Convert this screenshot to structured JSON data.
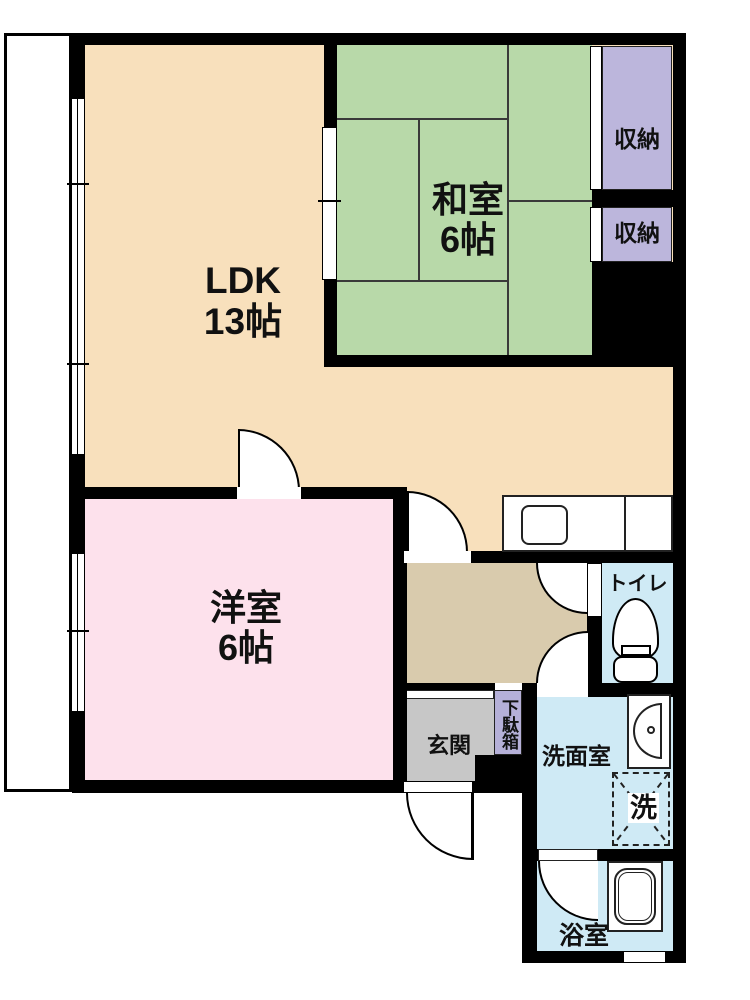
{
  "rooms": {
    "ldk": {
      "label": "LDK",
      "size": "13帖",
      "color": "#f8e0bc"
    },
    "washitsu": {
      "label": "和室",
      "size": "6帖",
      "color": "#b8d9a9"
    },
    "youshitsu": {
      "label": "洋室",
      "size": "6帖",
      "color": "#fde1ec"
    },
    "storage_top": {
      "label": "収納",
      "color": "#bcb6dc"
    },
    "storage_bottom": {
      "label": "収納",
      "color": "#bcb6dc"
    },
    "toilet": {
      "label": "トイレ",
      "color": "#cfeaf5"
    },
    "genkan": {
      "label": "玄関",
      "color": "#c7c7c7"
    },
    "getabako": {
      "label": "下駄箱",
      "color": "#b5b0d8"
    },
    "senmenshitsu": {
      "label": "洗面室",
      "color": "#cfeaf5"
    },
    "yokushitsu": {
      "label": "浴室",
      "color": "#cfeaf5"
    },
    "hallway": {
      "color": "#d9cbad"
    }
  },
  "fixtures": {
    "washing_machine": {
      "label": "洗"
    }
  },
  "colors": {
    "wall": "#000000",
    "balcony": "#ffffff",
    "tatami_line": "#3a3a3a"
  }
}
